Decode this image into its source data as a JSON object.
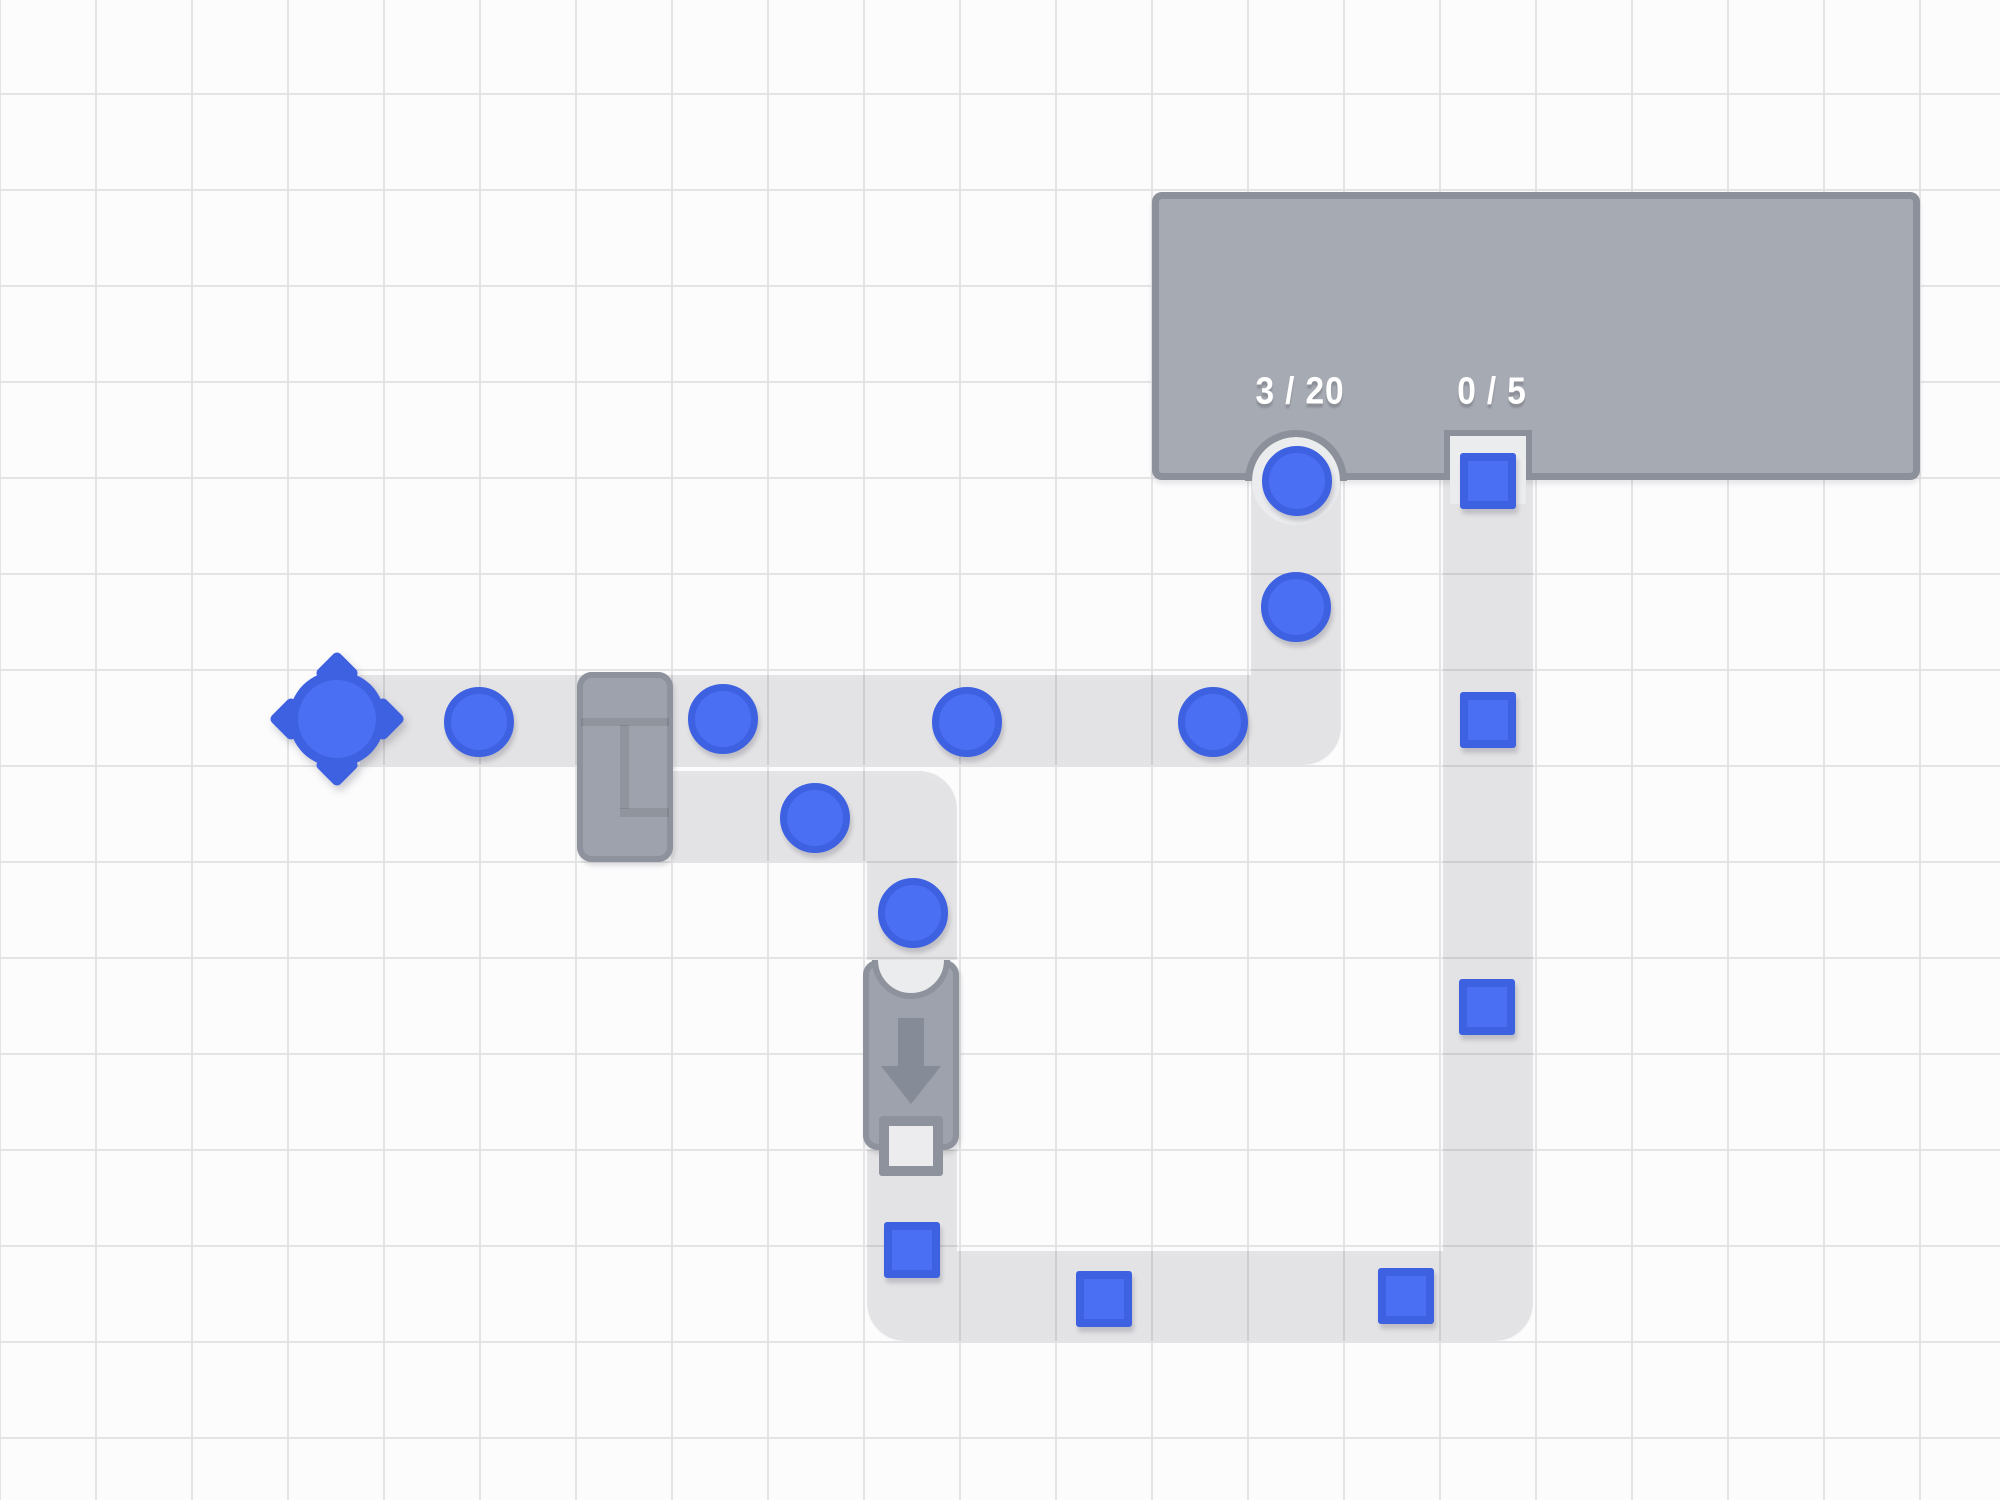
{
  "scene": {
    "width": 2000,
    "height": 1500,
    "grid_cell": 96,
    "description": "Factory-building game world: a circle resource node feeds a conveyor of blue circles to the hub; a splitter branches circles into a converter machine that outputs blue squares, which travel a conveyor loop to the hub's square input."
  },
  "colors": {
    "bg": "#fcfcfd",
    "grid_line": "#e3e4e6",
    "belt": "rgba(30,32,38,0.105)",
    "hub_fill": "#a6aab3",
    "hub_border": "#8b909b",
    "machine_fill": "#9da2ac",
    "machine_border": "#8d929c",
    "machine_detail": "#868c97",
    "notch_fill": "#ebecee",
    "item_fill": "#4b6ff2",
    "item_border": "#3d61e1",
    "label": "#ffffff"
  },
  "buildings": {
    "hub": {
      "x": 1152,
      "y": 192,
      "w": 768,
      "h": 288,
      "circle_counter": {
        "text": "3 / 20",
        "delivered": 3,
        "goal": 20,
        "x": 1300,
        "y": 392
      },
      "square_counter": {
        "text": "0 / 5",
        "delivered": 0,
        "goal": 5,
        "x": 1492,
        "y": 392
      },
      "circle_input": {
        "cx": 1296,
        "cy": 481
      },
      "square_input": {
        "cx": 1488,
        "cy": 455
      }
    },
    "spawner": {
      "cx": 337,
      "cy": 719
    },
    "splitter": {
      "x": 577,
      "y": 672,
      "w": 96,
      "h": 190
    },
    "converter": {
      "x": 863,
      "y": 960,
      "w": 96,
      "h": 190
    }
  },
  "belts": {
    "paths": [
      {
        "name": "main-circle-line",
        "segments": [
          {
            "x": 360,
            "y": 675,
            "w": 891,
            "h": 90
          },
          {
            "x": 1251,
            "y": 675,
            "w": 90,
            "h": 90,
            "r": "0 0 38px 0"
          },
          {
            "x": 1251,
            "y": 480,
            "w": 90,
            "h": 195
          }
        ]
      },
      {
        "name": "branch-to-converter",
        "segments": [
          {
            "x": 673,
            "y": 771,
            "w": 194,
            "h": 90
          },
          {
            "x": 867,
            "y": 771,
            "w": 90,
            "h": 90,
            "r": "0 38px 0 0"
          },
          {
            "x": 867,
            "y": 861,
            "w": 90,
            "h": 99
          }
        ]
      },
      {
        "name": "square-line",
        "segments": [
          {
            "x": 867,
            "y": 1150,
            "w": 90,
            "h": 101
          },
          {
            "x": 867,
            "y": 1251,
            "w": 90,
            "h": 90,
            "r": "0 0 0 38px"
          },
          {
            "x": 957,
            "y": 1251,
            "w": 486,
            "h": 90
          },
          {
            "x": 1443,
            "y": 1251,
            "w": 90,
            "h": 90,
            "r": "0 0 38px 0"
          },
          {
            "x": 1443,
            "y": 480,
            "w": 90,
            "h": 771
          }
        ]
      }
    ]
  },
  "items": {
    "circles": [
      {
        "x": 479,
        "y": 722
      },
      {
        "x": 723,
        "y": 719
      },
      {
        "x": 967,
        "y": 722
      },
      {
        "x": 1213,
        "y": 722
      },
      {
        "x": 1296,
        "y": 607
      },
      {
        "x": 1297,
        "y": 481
      },
      {
        "x": 815,
        "y": 818
      },
      {
        "x": 913,
        "y": 913
      }
    ],
    "squares": [
      {
        "x": 1488,
        "y": 481
      },
      {
        "x": 1488,
        "y": 720
      },
      {
        "x": 1487,
        "y": 1007
      },
      {
        "x": 912,
        "y": 1250
      },
      {
        "x": 1104,
        "y": 1299
      },
      {
        "x": 1406,
        "y": 1296
      }
    ]
  }
}
